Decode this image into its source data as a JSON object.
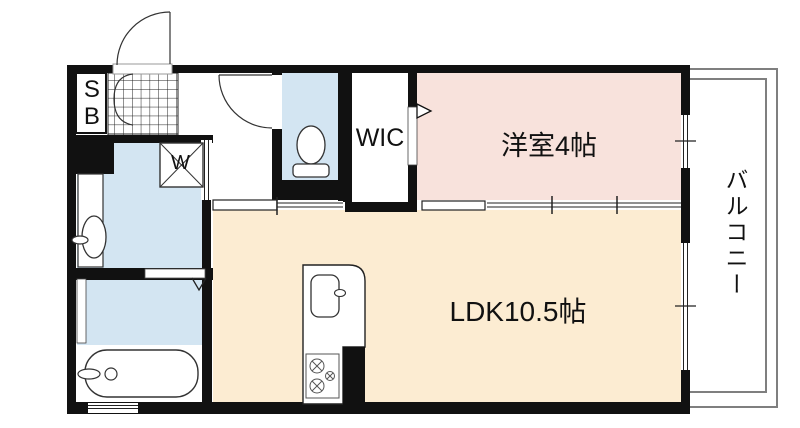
{
  "floorplan": {
    "title": "1LDK apartment floor plan",
    "labels": {
      "shoe_box": "SB",
      "washer": "W",
      "wic": "WIC",
      "western_room": "洋室4帖",
      "ldk": "LDK10.5帖",
      "balcony": "バルコニー"
    },
    "colors": {
      "wall": "#111111",
      "wet_room_fill": "#d3e5f2",
      "western_room_fill": "#f8e2dc",
      "ldk_fill": "#fcecd2",
      "balcony_line": "#7f7f7f",
      "fixture_line": "#222222"
    }
  }
}
